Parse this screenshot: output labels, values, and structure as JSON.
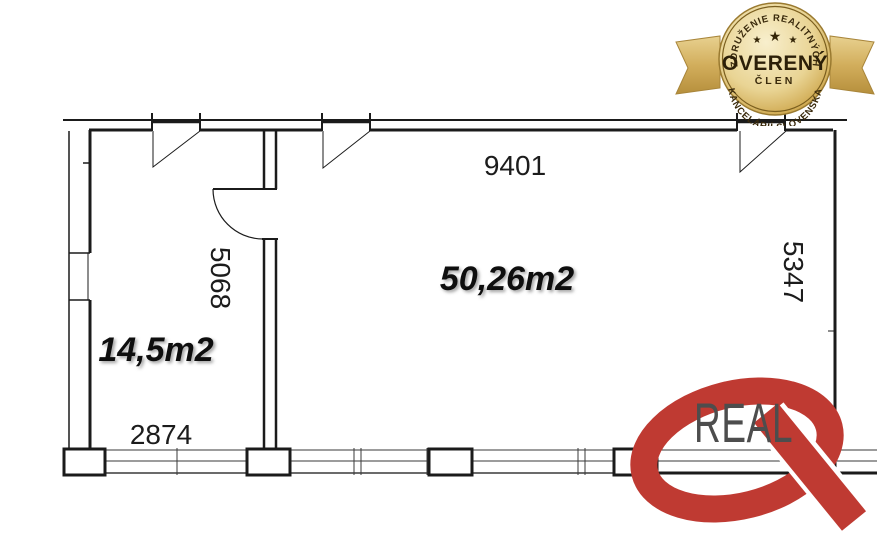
{
  "badge": {
    "arc_top": "ZDRUŽENIE REALITNÝCH",
    "arc_bottom": "KANCELÁRIÍ SLOVENSKA",
    "title": "OVERENÝ",
    "subtitle": "ČLEN",
    "star": "★",
    "colors": {
      "gold_light": "#f8efcd",
      "gold": "#d2ac56",
      "gold_dark": "#b9913a",
      "ribbon": "#d2ae5c",
      "text": "#342507"
    }
  },
  "floor_plan": {
    "line_color": "#1b1b1b",
    "rooms": [
      {
        "id": "left-room",
        "area": "14,5m2"
      },
      {
        "id": "main-room",
        "area": "50,26m2"
      }
    ],
    "dimensions": {
      "top": "9401",
      "left_vertical": "5068",
      "right_vertical": "5347",
      "bottom": "2874"
    }
  },
  "logo": {
    "text": "REAL",
    "q_color": "#bf3a32",
    "text_color": "#4d4d4d"
  }
}
